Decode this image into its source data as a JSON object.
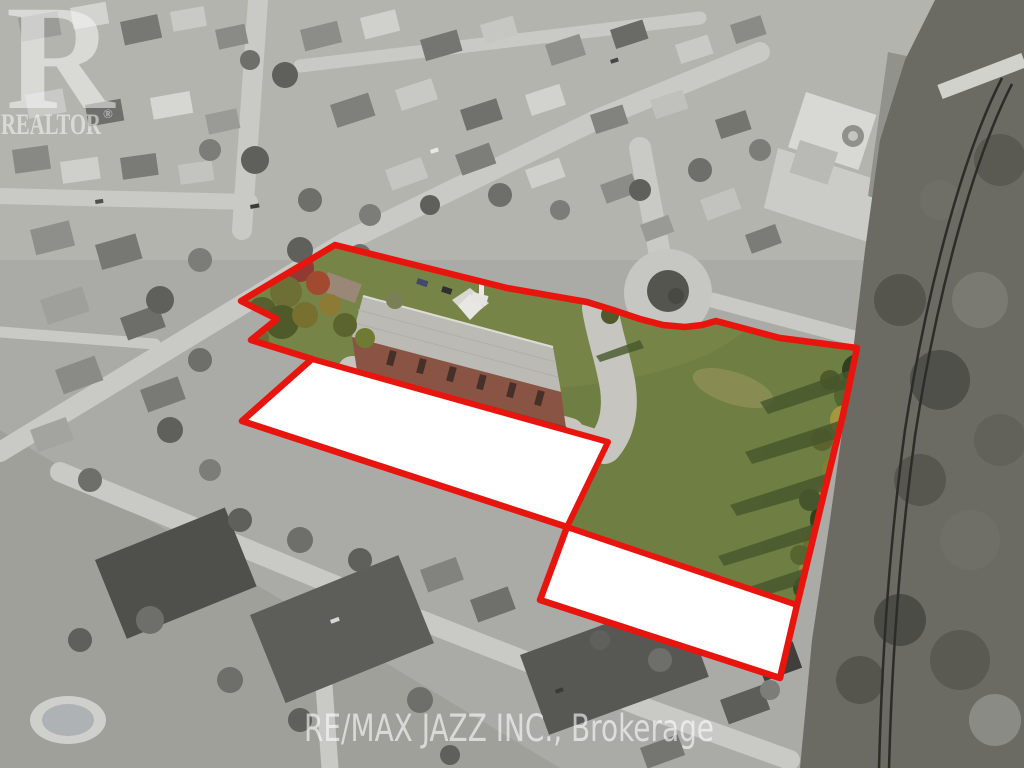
{
  "scene": {
    "type": "aerial-real-estate-photo"
  },
  "watermarks": {
    "logo_letter": "R",
    "logo_text": "REALTOR",
    "registered_mark": "®",
    "brokerage": "RE/MAX JAZZ INC., Brokerage"
  },
  "colors": {
    "boundary_red": "#e8140e",
    "mask_white": "#ffffff",
    "lawn_green": "#6f7f43",
    "watermark_white": "#f5f5f5"
  }
}
